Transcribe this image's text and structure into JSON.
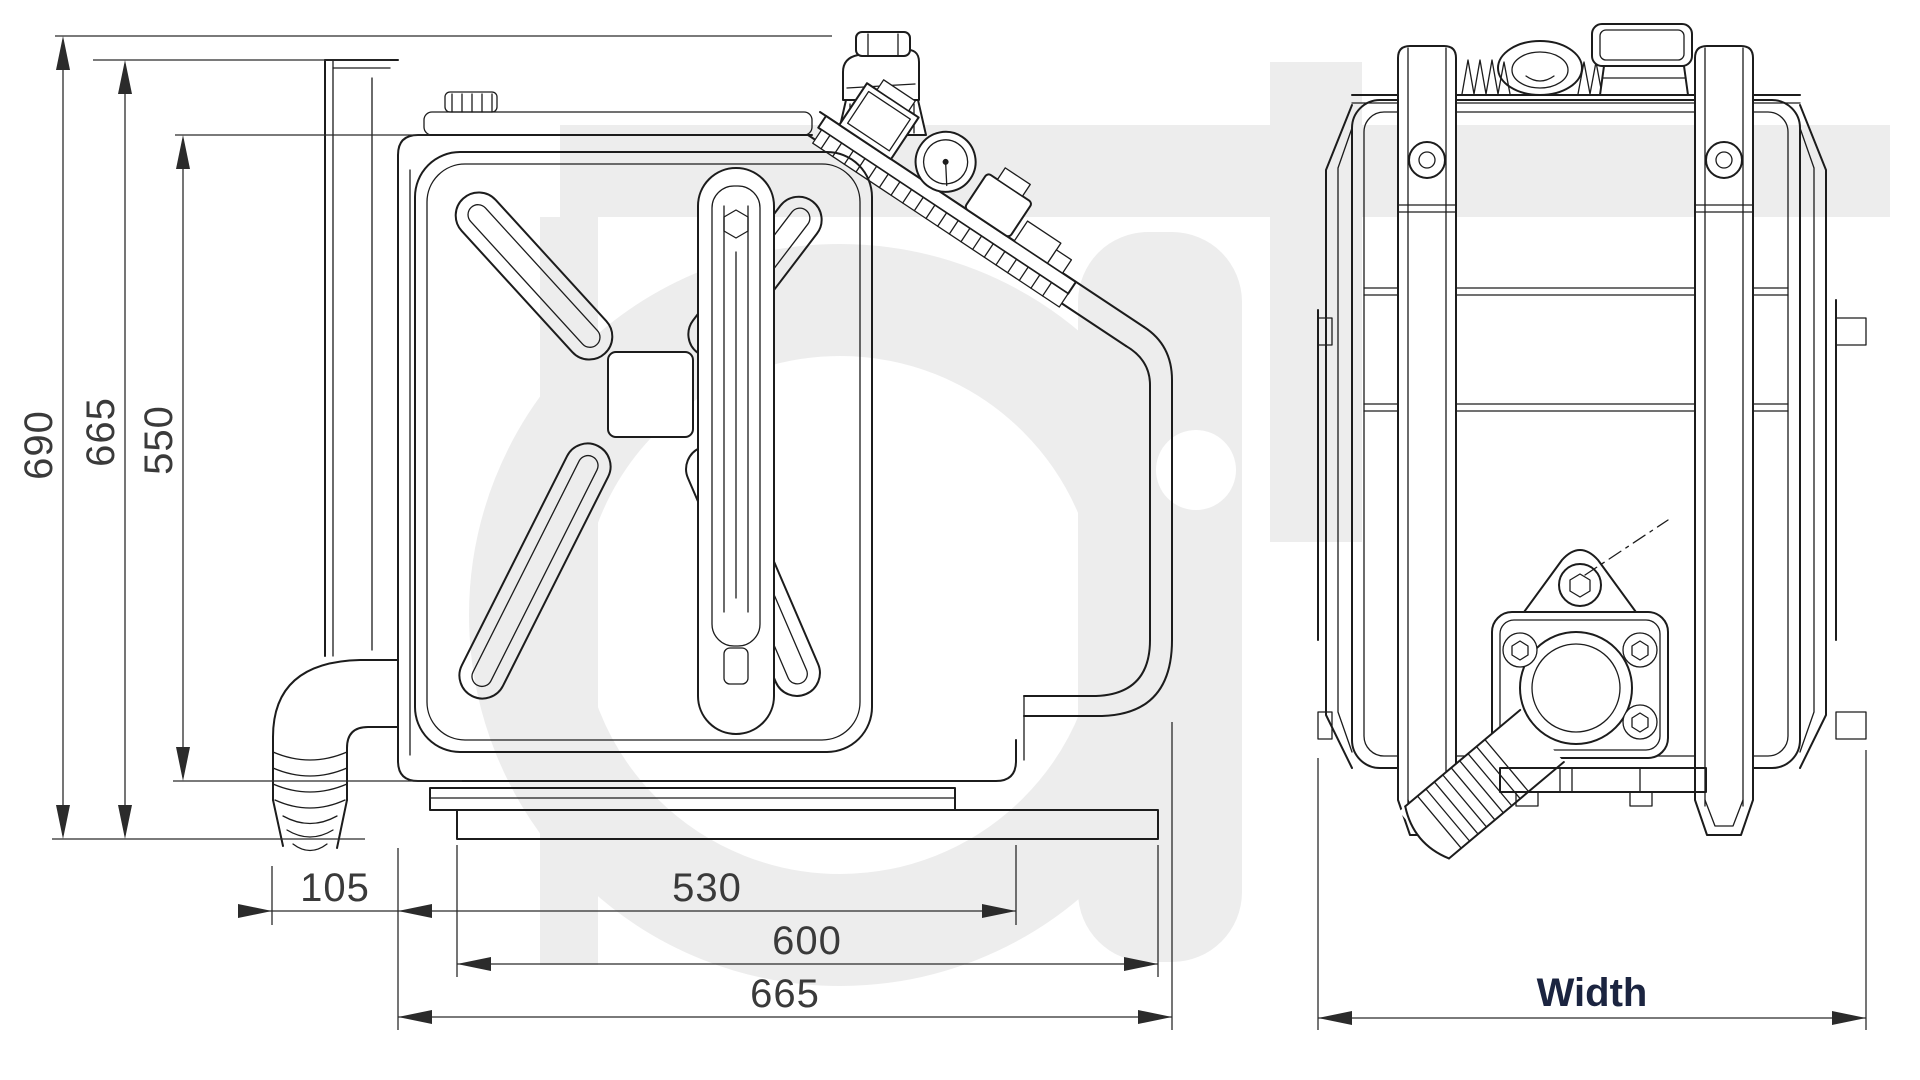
{
  "drawing": {
    "background": "#ffffff",
    "line_color": "#1c1c1c",
    "watermark_color": "#ededed",
    "dimension_text_color": "#3a3a3a",
    "width_label_color": "#1b2440"
  },
  "front_view": {
    "vertical_dimensions": [
      {
        "label": "690"
      },
      {
        "label": "665"
      },
      {
        "label": "550"
      }
    ],
    "horizontal_dimensions": [
      {
        "label": "105"
      },
      {
        "label": "530"
      },
      {
        "label": "600"
      },
      {
        "label": "665"
      }
    ]
  },
  "side_view": {
    "horizontal_dimensions": [
      {
        "label": "Width"
      }
    ]
  }
}
